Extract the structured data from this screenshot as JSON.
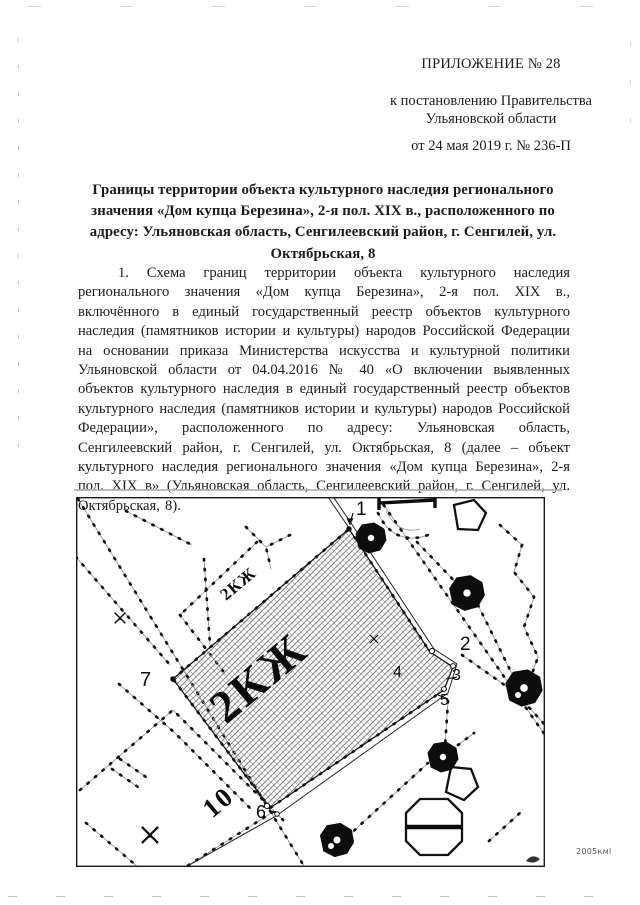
{
  "doc": {
    "appendix": "ПРИЛОЖЕНИЕ № 28",
    "decree": [
      "к постановлению Правительства",
      "Ульяновской области"
    ],
    "decree_date": "от 24 мая 2019 г. № 236-П",
    "title": "Границы территории объекта культурного наследия регионального значения «Дом купца Березина», 2-я пол. XIX в., расположенного по адресу: Ульяновская область, Сенгилеевский район, г. Сенгилей, ул. Октябрьская, 8",
    "paragraph": "1. Схема границ территории объекта культурного наследия регионального значения «Дом купца Березина», 2-я пол. XIX в., включённого в единый государственный реестр объектов культурного наследия (памятников истории и культуры) народов Российской Федерации на основании приказа Министерства искусства и культурной политики Ульяновской области от 04.04.2016 № 40 «О включении выявленных объектов культурного наследия в единый государственный реестр объектов культурного наследия (памятников истории и культуры) народов Российской Федерации», расположенного по адресу: Ульяновская область, Сенгилеевский район, г. Сенгилей, ул. Октябрьская, 8 (далее – объект культурного наследия регионального значения «Дом купца Березина», 2-я пол. XIX в» (Ульяновская область, Сенгилеевский район, г. Сенгилей, ул. Октябрьская, 8)."
  },
  "map": {
    "points": {
      "p1": "1",
      "p2": "2",
      "p3": "3",
      "p4": "4",
      "p5": "5",
      "p6": "6",
      "p7": "7"
    },
    "territory_label": "2КЖ",
    "neighbor_label": "2КЖ",
    "house_number": "10",
    "corner_note": "2005кмl",
    "ink_color": "#111111",
    "hatch_color": "#6e6e6e"
  }
}
